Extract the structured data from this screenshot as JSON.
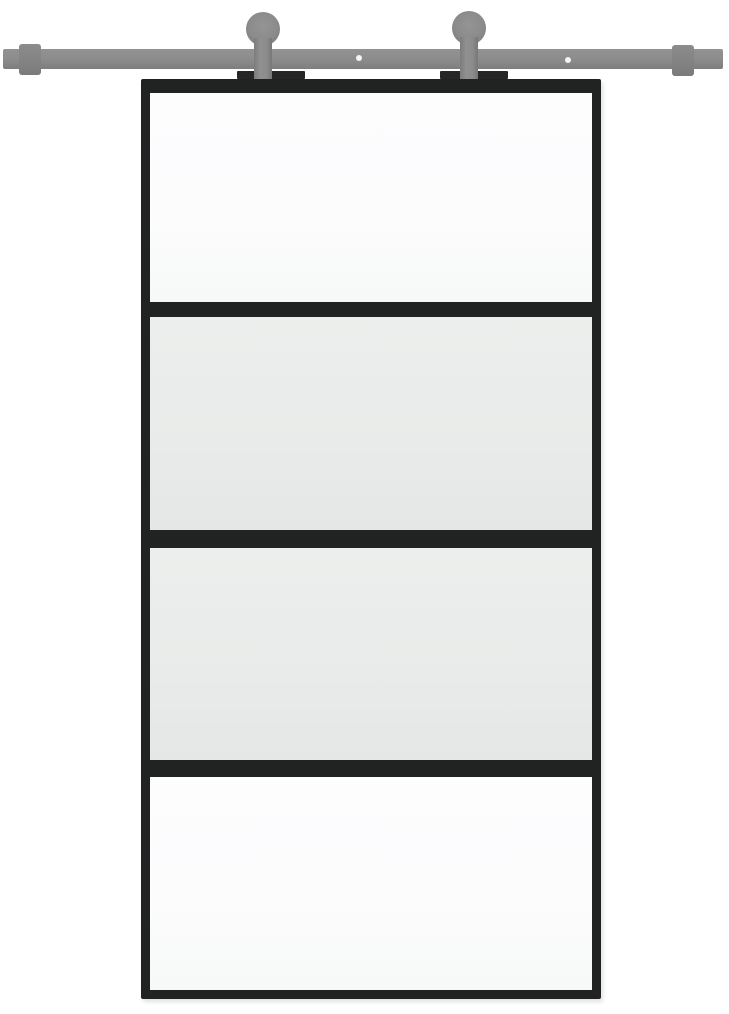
{
  "scene": {
    "description": "Studio product photograph of a black-framed sliding barn door with four horizontal glass panels, hung from a grey wall-mount sliding rail by two round roller hangers",
    "background_color": "#ffffff"
  },
  "colors": {
    "background": "#ffffff",
    "rail_grey": "#8b8b8b",
    "hardware_grey_dark": "#7b7b7b",
    "hanger_plate_black": "#262626",
    "door_frame_black": "#212322",
    "glass_clear": "#fcfcfd",
    "glass_frosted": "#e9ebea",
    "screw_hole_white": "#f5f5f5"
  },
  "hardware": {
    "rail": {
      "label": "sliding rail",
      "end_stops": [
        "left",
        "right"
      ],
      "screw_holes": [
        "left",
        "right"
      ]
    },
    "rollers": [
      {
        "side": "left",
        "parts": [
          "wheel",
          "strap",
          "mounting-plate"
        ]
      },
      {
        "side": "right",
        "parts": [
          "wheel",
          "strap",
          "mounting-plate"
        ]
      }
    ]
  },
  "door": {
    "frame": "black",
    "panels": [
      {
        "position": 1,
        "appearance": "clear"
      },
      {
        "position": 2,
        "appearance": "frosted"
      },
      {
        "position": 3,
        "appearance": "frosted"
      },
      {
        "position": 4,
        "appearance": "clear"
      }
    ]
  }
}
